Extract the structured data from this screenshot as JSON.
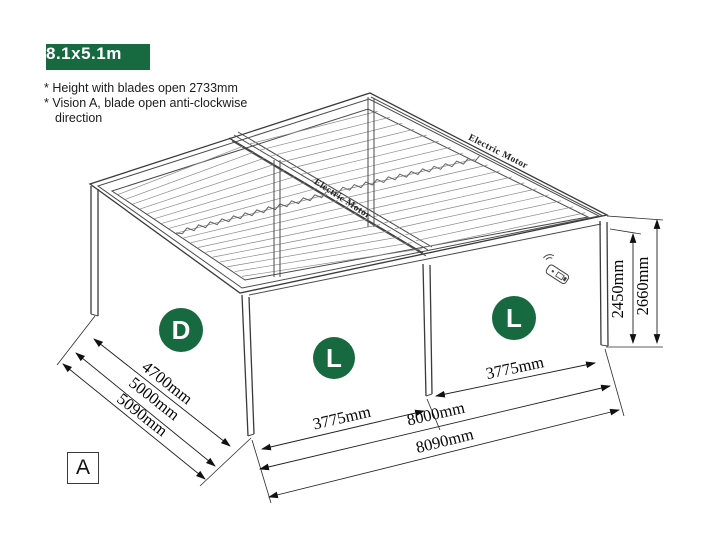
{
  "badge": {
    "label": "8.1x5.1m"
  },
  "notes": {
    "line1": "* Height with blades open 2733mm",
    "line2": "* Vision A, blade open anti-clockwise",
    "line3": "direction"
  },
  "colors": {
    "accent_green": "#17693f",
    "line_color": "#3c3c3c"
  },
  "diagram": {
    "motor_label_left": "Electric Motor",
    "motor_label_right": "Electric Motor",
    "markers": [
      {
        "letter": "D"
      },
      {
        "letter": "L"
      },
      {
        "letter": "L"
      }
    ],
    "dimensions": {
      "depth_inner": "4700mm",
      "depth_frame": "5000mm",
      "depth_overall": "5090mm",
      "bay_left": "3775mm",
      "bay_right": "3775mm",
      "width_frame": "8000mm",
      "width_overall": "8090mm",
      "height_post": "2450mm",
      "height_overall": "2660mm"
    },
    "icons": {
      "remote": "remote-control-icon"
    }
  },
  "view_label": {
    "label": "A"
  }
}
